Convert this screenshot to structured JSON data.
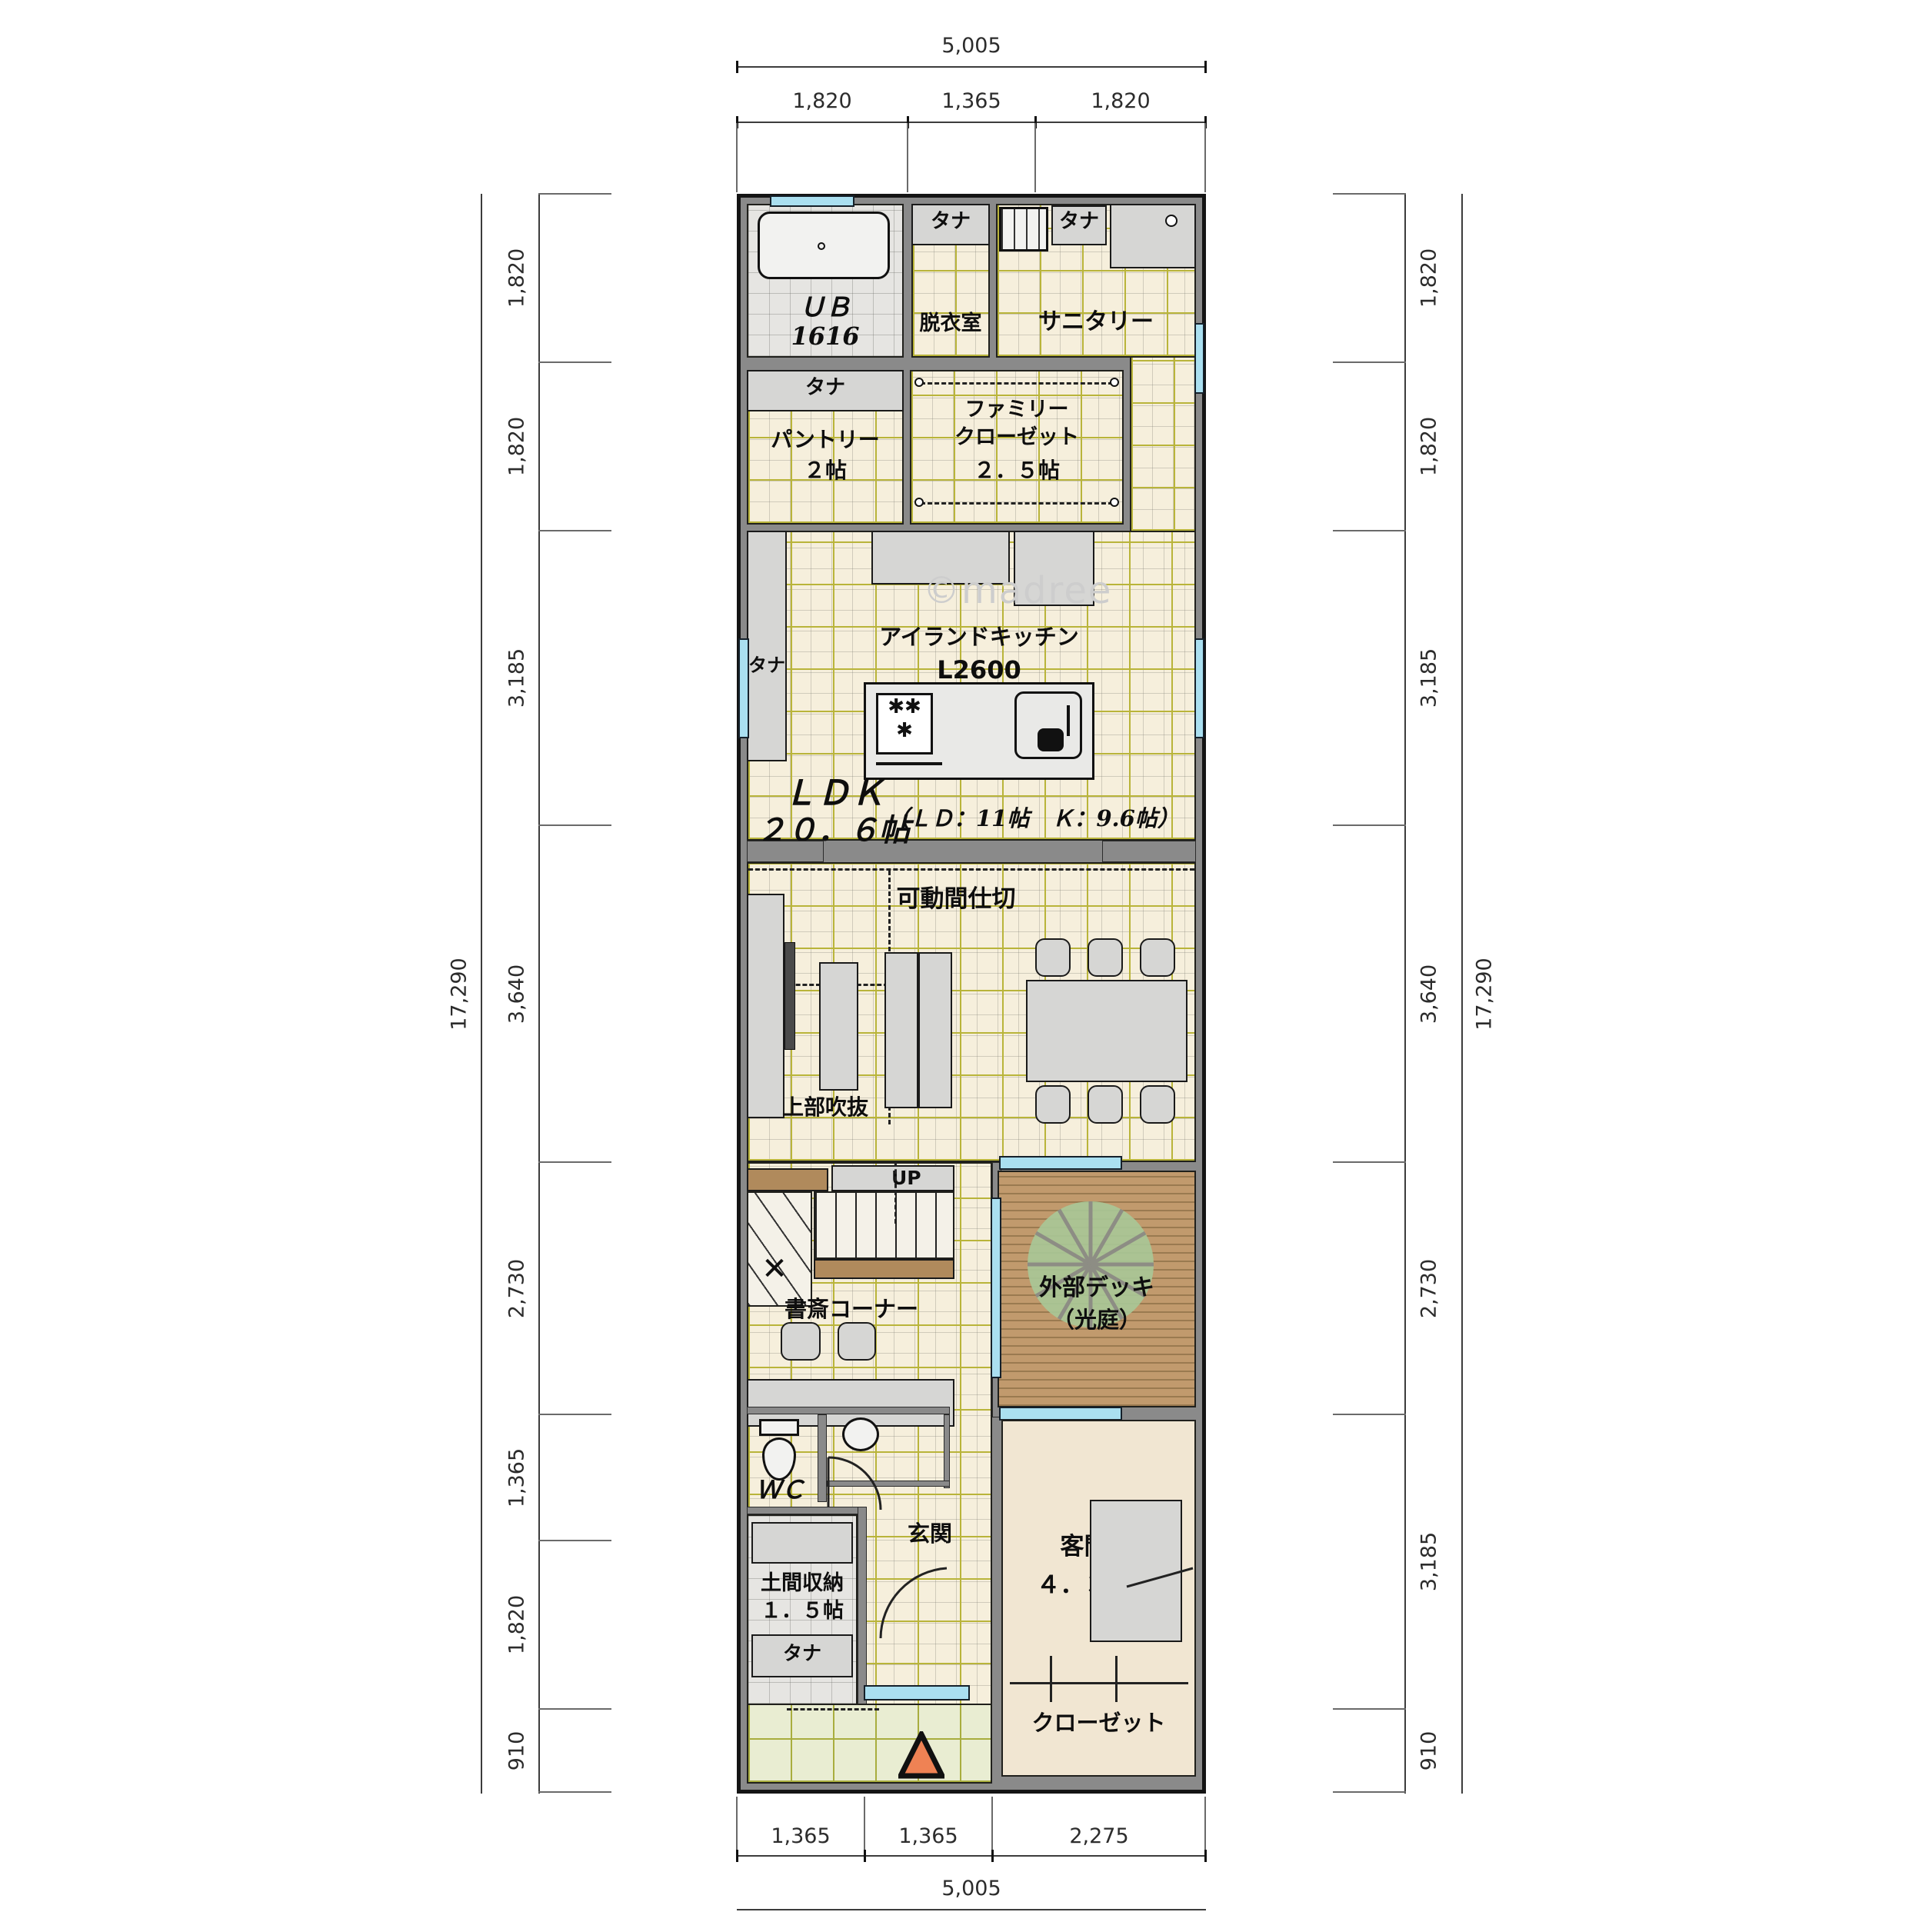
{
  "watermark": "©madree",
  "colors": {
    "wall": "#8a8a8a",
    "floor_tile": "#f6efdc",
    "grid_line": "#b9b43a",
    "deck_wood": "#c19a6d",
    "window_glass": "#aadff0",
    "porch_tile": "#e9edd2",
    "guest_floor": "#f1e6d2",
    "entry_marker": "#ef8254",
    "plant_green": "#a9c897",
    "handrail_brown": "#b08a5c",
    "furniture_gray": "#d6d6d4"
  },
  "dims": {
    "top": {
      "overall": "5,005",
      "segments": [
        "1,820",
        "1,365",
        "1,820"
      ]
    },
    "bottom": {
      "overall": "5,005",
      "segments": [
        "1,365",
        "1,365",
        "2,275"
      ]
    },
    "left": {
      "overall": "17,290",
      "segments": [
        "1,820",
        "1,820",
        "3,185",
        "3,640",
        "2,730",
        "1,365",
        "1,820",
        "910"
      ]
    },
    "right": {
      "overall": "17,290",
      "segments": [
        "1,820",
        "1,820",
        "3,185",
        "3,640",
        "2,730",
        "3,185",
        "910"
      ]
    }
  },
  "rooms": {
    "ub": {
      "name": "ＵＢ",
      "size": "1616"
    },
    "dressing": {
      "name": "脱衣室"
    },
    "sanitary": {
      "name": "サニタリー"
    },
    "pantry": {
      "name": "パントリー",
      "size": "２帖"
    },
    "family_closet": {
      "line1": "ファミリー",
      "line2": "クローゼット",
      "size": "２．５帖"
    },
    "kitchen": {
      "name": "アイランドキッチン",
      "size": "L2600"
    },
    "ldk": {
      "name": "ＬＤＫ",
      "size": "２０．６帖",
      "detail": "（ＬＤ：11帖　Ｋ：9.6帖）"
    },
    "partition": {
      "name": "可動間仕切"
    },
    "void_above": {
      "name": "上部吹抜"
    },
    "stairs": {
      "up": "UP",
      "arrow": "✕"
    },
    "study": {
      "name": "書斎コーナー"
    },
    "deck": {
      "name": "外部デッキ",
      "sub": "（光庭）"
    },
    "wc": {
      "name": "ＷＣ"
    },
    "entrance": {
      "name": "玄関"
    },
    "doma": {
      "name": "土間収納",
      "size": "１．５帖"
    },
    "guest": {
      "name": "客間",
      "size": "４．３帖"
    },
    "closet": {
      "name": "クローゼット"
    },
    "shelf": "タナ"
  }
}
